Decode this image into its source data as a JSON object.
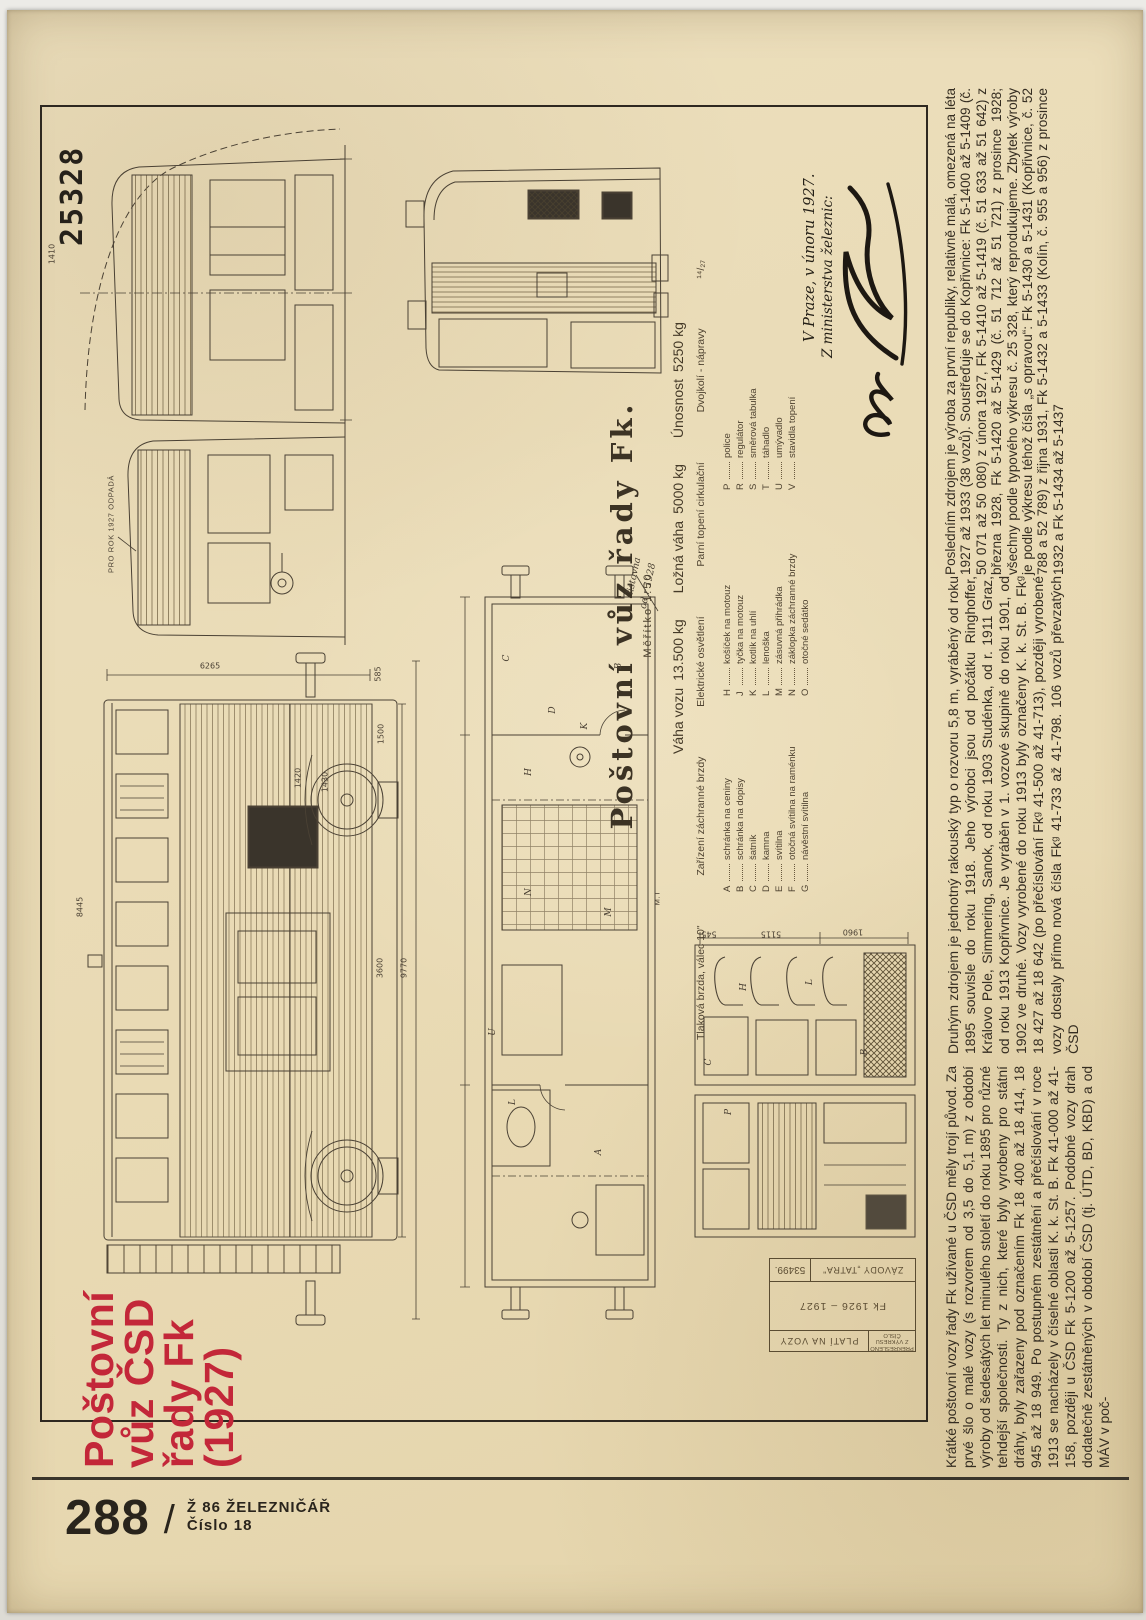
{
  "page": {
    "drawing_number": "25328",
    "accent_red": "#c32739",
    "paper_color": "#e9dab4",
    "ink_color": "#4a4033"
  },
  "title": {
    "line1": "Poštovní",
    "line2": "vůz ČSD",
    "line3": "řady Fk",
    "line4": "(1927)"
  },
  "footer": {
    "page_number": "288",
    "separator": "/",
    "journal": "Ž 86 ŽELEZNIČÁŘ",
    "issue": "Číslo 18"
  },
  "legend": {
    "title": "Poštovní vůz řady Fk.",
    "scale": "Měřítko 1:50",
    "weights": [
      {
        "label": "Váha vozu",
        "value": "13.500 kg"
      },
      {
        "label": "Ložná váha",
        "value": "5000 kg"
      },
      {
        "label": "Únosnost",
        "value": "5250 kg"
      }
    ],
    "equipment_line": [
      "Tlaková brzda, válec 10\"",
      "Zařízení záchranné brzdy",
      "Elektrické osvětlení",
      "Parní topení cirkulační",
      "Dvojkolí - nápravy"
    ],
    "axle_fraction": "¹⁴/₂₇",
    "items_col1": [
      {
        "k": "A",
        "v": "schránka na ceniny"
      },
      {
        "k": "B",
        "v": "schránka na dopisy"
      },
      {
        "k": "C",
        "v": "šatník"
      },
      {
        "k": "D",
        "v": "kamna"
      },
      {
        "k": "E",
        "v": "svítilna"
      },
      {
        "k": "F",
        "v": "otočná svítilna na raménku"
      },
      {
        "k": "G",
        "v": "návěstní svítilna"
      }
    ],
    "items_col2": [
      {
        "k": "H",
        "v": "košíček na motouz"
      },
      {
        "k": "J",
        "v": "tyčka na motouz"
      },
      {
        "k": "K",
        "v": "kotlík na uhlí"
      },
      {
        "k": "L",
        "v": "lenoška"
      },
      {
        "k": "M",
        "v": "zásuvná přihrádka"
      },
      {
        "k": "N",
        "v": "záklopka záchranné brzdy"
      },
      {
        "k": "O",
        "v": "otočné sedátko"
      }
    ],
    "items_col3": [
      {
        "k": "P",
        "v": "police"
      },
      {
        "k": "R",
        "v": "regulátor"
      },
      {
        "k": "S",
        "v": "směrová tabulka"
      },
      {
        "k": "T",
        "v": "táhadlo"
      },
      {
        "k": "U",
        "v": "umývadlo"
      },
      {
        "k": "V",
        "v": "stavidla topení"
      }
    ]
  },
  "signature": {
    "place_date": "V Praze, v únoru  1927.",
    "from": "Z ministerstva železnic:"
  },
  "stamp": {
    "redrawn": "PŘEKRESLENO Z VÝKRESU ČÍSLO",
    "valid_for": "PLATÍ NA VOZY",
    "series": "Fk 1926 – 1927",
    "works": "ZÁVODY „TATRA\"",
    "number": "53499."
  },
  "article": {
    "columns": [
      {
        "text": "Krátké poštovní vozy řady Fk užívané u ČSD měly trojí původ. Za prvé šlo o malé vozy (s rozvorem od 3,5 do 5,1 m) z období výroby od šedesátých let minulého století do roku 1895 pro různé tehdejší společnosti. Ty z nich, které byly vyrobeny pro státní dráhy, byly zařazeny pod označením Fk 18 400 až 18 414, 18 945 až 18 949. Po postupném zestátnění a přečíslování v roce 1913 se nacházely v číselné oblasti K. k. St. B. Fk 41-000 až 41-158, později u ČSD Fk 5-1200 až 5-1257. Podobné vozy drah dodatečně zestátněných v období ČSD (tj. ÚTD, BD, KBD) a od MÁV v poč-"
      },
      {
        "text": "Druhým zdrojem je jednotný rakouský typ o rozvoru 5,8 m, vyráběný od roku 1895 souvisle do roku 1918. Jeho výrobci jsou od počátku Ringhoffer, Královo Pole, Simmering, Sanok, od roku 1903 Studénka, od r. 1911 Graz, od roku 1913 Kopřivnice. Je vyráběn v 1. vozové skupině do roku 1901, od 1902 ve druhé. Vozy vyrobené do roku 1913 byly označeny K. k. St. B. Fkᵍ 18 427 až 18 642 (po přečíslování Fkᵍ 41-500 až 41-713), později vyrobené vozy dostaly přímo nová čísla Fkᵍ 41-733 až 41-798. 106 vozů převzatých ČSD"
      },
      {
        "text": "Posledním zdrojem je výroba za první republiky, relativně malá, omezená na léta 1927 až 1933 (38 vozů). Soustřeďuje se do Kopřivnice: Fk 5-1400 až 5-1409 (č. 50 071 až 50 080) z února 1927, Fk 5-1410 až 5-1419 (č. 51 633 až 51 642) z března 1928, Fk 5-1420 až 5-1429 (č. 51 712 až 51 721) z prosince 1928; všechny podle typového výkresu č. 25 328, který reprodukujeme. Zbytek výroby je podle výkresu téhož čísla „s opravou“: Fk 5-1430 a 5-1431 (Kopřivnice, č. 52 788 a 52 789) z řijna 1931, Fk 5-1432 a 5-1433 (Kolín, č. 955 a 956) z prosince 1932 a Fk 5-1434 až 5-1437"
      }
    ]
  },
  "drawing_labels": [
    {
      "t": "6265",
      "x": 203,
      "y": 656,
      "r": 0,
      "c": "dim"
    },
    {
      "t": "585",
      "x": 371,
      "y": 664,
      "r": -90,
      "c": "dim"
    },
    {
      "t": "8445",
      "x": 73,
      "y": 897,
      "r": -90,
      "c": "dim"
    },
    {
      "t": "1420",
      "x": 291,
      "y": 768,
      "r": -90,
      "c": "dim"
    },
    {
      "t": "1430",
      "x": 318,
      "y": 772,
      "r": -90,
      "c": "dim"
    },
    {
      "t": "1500",
      "x": 374,
      "y": 724,
      "r": -90,
      "c": "dim"
    },
    {
      "t": "3600",
      "x": 373,
      "y": 958,
      "r": -90,
      "c": "dim"
    },
    {
      "t": "9770",
      "x": 397,
      "y": 958,
      "r": -90,
      "c": "dim"
    },
    {
      "t": "1410",
      "x": 45,
      "y": 244,
      "r": -90,
      "c": "dim"
    },
    {
      "t": "5115",
      "x": 764,
      "y": 924,
      "r": 180,
      "c": "dim"
    },
    {
      "t": "1960",
      "x": 846,
      "y": 922,
      "r": 180,
      "c": "dim"
    },
    {
      "t": "545",
      "x": 702,
      "y": 924,
      "r": 180,
      "c": "dim"
    },
    {
      "t": "PRO ROK 1927 ODPADÁ",
      "x": 104,
      "y": 514,
      "r": -90,
      "c": "note-caps"
    },
    {
      "t": "listovna",
      "x": 627,
      "y": 566,
      "r": -78,
      "c": "note-hand"
    },
    {
      "t": "od r 1928",
      "x": 641,
      "y": 576,
      "r": -78,
      "c": "note-hand"
    },
    {
      "t": "M.T",
      "x": 650,
      "y": 888,
      "r": -90,
      "c": "note-caps"
    },
    {
      "t": "A",
      "x": 592,
      "y": 1142,
      "r": -90,
      "c": "plt"
    },
    {
      "t": "B",
      "x": 612,
      "y": 656,
      "r": -90,
      "c": "plt"
    },
    {
      "t": "C",
      "x": 500,
      "y": 648,
      "r": -90,
      "c": "plt"
    },
    {
      "t": "D",
      "x": 546,
      "y": 700,
      "r": -90,
      "c": "plt"
    },
    {
      "t": "H",
      "x": 522,
      "y": 762,
      "r": -90,
      "c": "plt"
    },
    {
      "t": "K",
      "x": 578,
      "y": 716,
      "r": -90,
      "c": "plt"
    },
    {
      "t": "L",
      "x": 506,
      "y": 1092,
      "r": -90,
      "c": "plt"
    },
    {
      "t": "U",
      "x": 486,
      "y": 1022,
      "r": -90,
      "c": "plt"
    },
    {
      "t": "M",
      "x": 602,
      "y": 902,
      "r": -90,
      "c": "plt"
    },
    {
      "t": "N",
      "x": 522,
      "y": 882,
      "r": -90,
      "c": "plt"
    },
    {
      "t": "H",
      "x": 737,
      "y": 977,
      "r": -90,
      "c": "plt"
    },
    {
      "t": "L",
      "x": 803,
      "y": 972,
      "r": -90,
      "c": "plt"
    },
    {
      "t": "C",
      "x": 702,
      "y": 1052,
      "r": -90,
      "c": "plt"
    },
    {
      "t": "B",
      "x": 858,
      "y": 1042,
      "r": -90,
      "c": "plt"
    },
    {
      "t": "P",
      "x": 722,
      "y": 1102,
      "r": -90,
      "c": "plt"
    }
  ]
}
